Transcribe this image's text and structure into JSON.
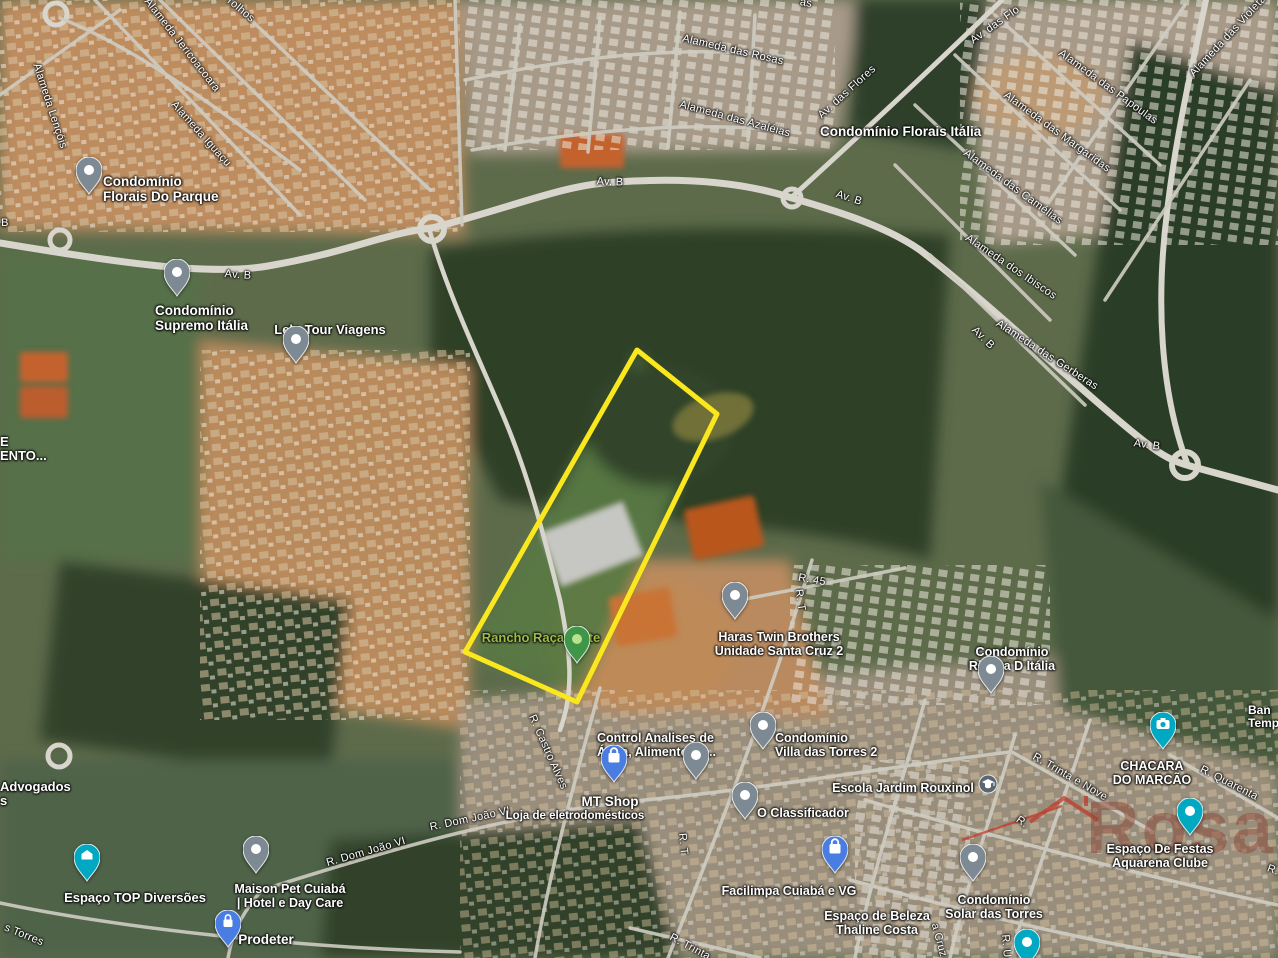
{
  "map": {
    "type": "satellite-map",
    "watermark": {
      "text": "Rosa",
      "text_color": "#8a4434",
      "accent_color": "#c0392b"
    },
    "property_outline": {
      "color": "#fbe71d",
      "points": "637,350 717,414 577,702 465,652"
    },
    "pin_colors": {
      "gray": "#7e8a93",
      "blue": "#4a7de2",
      "teal": "#00a9c1",
      "green": "#3f9648"
    },
    "street_labels": [
      {
        "t": "Alameda Jericoacoara",
        "x": 182,
        "y": 45,
        "r": 52
      },
      {
        "t": "rolhos",
        "x": 241,
        "y": 10,
        "r": 40
      },
      {
        "t": "Alameda Lençóis",
        "x": 50,
        "y": 106,
        "r": 72
      },
      {
        "t": "Alameda Iguaçu",
        "x": 201,
        "y": 134,
        "r": 48
      },
      {
        "t": "B",
        "x": 5,
        "y": 223,
        "r": 0
      },
      {
        "t": "Av. B",
        "x": 238,
        "y": 275,
        "r": 4
      },
      {
        "t": "Av. B",
        "x": 610,
        "y": 182,
        "r": 2
      },
      {
        "t": "Av. B",
        "x": 849,
        "y": 198,
        "r": 18
      },
      {
        "t": "Av. das Flores",
        "x": 847,
        "y": 92,
        "r": -42
      },
      {
        "t": "Av. das Flo",
        "x": 995,
        "y": 25,
        "r": -35
      },
      {
        "t": "as",
        "x": 806,
        "y": 3,
        "r": 10
      },
      {
        "t": "Alameda das Rosas",
        "x": 733,
        "y": 50,
        "r": 13
      },
      {
        "t": "Alameda das Azaléias",
        "x": 735,
        "y": 119,
        "r": 15
      },
      {
        "t": "Alameda das Papoulas",
        "x": 1108,
        "y": 87,
        "r": 36
      },
      {
        "t": "Alameda das Violeta",
        "x": 1228,
        "y": 36,
        "r": -47
      },
      {
        "t": "Alameda das Margaridas",
        "x": 1057,
        "y": 132,
        "r": 36
      },
      {
        "t": "Alameda das Camélias",
        "x": 1013,
        "y": 187,
        "r": 36
      },
      {
        "t": "Alameda dos Ibiscos",
        "x": 1011,
        "y": 267,
        "r": 34
      },
      {
        "t": "Alameda das Gerberas",
        "x": 1047,
        "y": 355,
        "r": 33
      },
      {
        "t": "Av. B",
        "x": 983,
        "y": 338,
        "r": 45
      },
      {
        "t": "Av. B",
        "x": 1147,
        "y": 445,
        "r": 8
      },
      {
        "t": "R. 45",
        "x": 812,
        "y": 580,
        "r": 10
      },
      {
        "t": "R. T",
        "x": 800,
        "y": 600,
        "r": 82
      },
      {
        "t": "R. T",
        "x": 683,
        "y": 844,
        "r": 85
      },
      {
        "t": "R. Castro Alves",
        "x": 548,
        "y": 752,
        "r": 66
      },
      {
        "t": "R. Dom João VI",
        "x": 470,
        "y": 819,
        "r": -12
      },
      {
        "t": "R. Dom João VI",
        "x": 366,
        "y": 852,
        "r": -16
      },
      {
        "t": "R. Trinta e Nove",
        "x": 1070,
        "y": 777,
        "r": 30
      },
      {
        "t": "R. Quarenta",
        "x": 1229,
        "y": 783,
        "r": 27
      },
      {
        "t": "R.",
        "x": 1022,
        "y": 822,
        "r": 35
      },
      {
        "t": "R. Trinta",
        "x": 690,
        "y": 947,
        "r": 28
      },
      {
        "t": "R. U",
        "x": 1006,
        "y": 946,
        "r": 85
      },
      {
        "t": "a Cruz",
        "x": 939,
        "y": 940,
        "r": 75
      },
      {
        "t": "s Torres",
        "x": 24,
        "y": 935,
        "r": 22
      },
      {
        "t": "R.",
        "x": 1273,
        "y": 870,
        "r": 20
      }
    ],
    "poi_labels": [
      {
        "lines": [
          "Condomínio",
          "Florais Do Parque"
        ],
        "x": 103,
        "y": 183,
        "align": "left",
        "size": 13.5
      },
      {
        "lines": [
          "Condomínio",
          "Supremo Itália"
        ],
        "x": 155,
        "y": 312,
        "align": "left",
        "size": 13.5
      },
      {
        "lines": [
          "Lelo Tour Viagens"
        ],
        "x": 330,
        "y": 332,
        "align": "center",
        "size": 13
      },
      {
        "lines": [
          "Condomínio Florais Itália"
        ],
        "x": 820,
        "y": 133,
        "align": "left",
        "size": 13.5
      },
      {
        "lines": [
          "Rancho Raça Forte"
        ],
        "x": 541,
        "y": 640,
        "align": "center",
        "size": 13,
        "color": "#9dbb46"
      },
      {
        "lines": [
          "Haras Twin Brothers",
          "Unidade Santa Cruz 2"
        ],
        "x": 779,
        "y": 639,
        "align": "center",
        "size": 12.5
      },
      {
        "lines": [
          "Condomínio",
          "Riviera D Itália"
        ],
        "x": 1012,
        "y": 654,
        "align": "center",
        "size": 12.5
      },
      {
        "lines": [
          "Control Analises de",
          "Água, Alimentos e..."
        ],
        "x": 597,
        "y": 740,
        "align": "left",
        "size": 12.5
      },
      {
        "lines": [
          "Condomínio",
          "Villa das Torres 2"
        ],
        "x": 775,
        "y": 740,
        "align": "left",
        "size": 12.5
      },
      {
        "lines": [
          "MT Shop"
        ],
        "x": 610,
        "y": 803,
        "align": "center",
        "size": 13.5
      },
      {
        "lines": [
          "Loja de eletrodomésticos"
        ],
        "x": 575,
        "y": 818,
        "align": "center",
        "size": 11.5
      },
      {
        "lines": [
          "O Classificador"
        ],
        "x": 803,
        "y": 815,
        "align": "center",
        "size": 12.5
      },
      {
        "lines": [
          "Escola Jardim Rouxinol"
        ],
        "x": 903,
        "y": 790,
        "align": "center",
        "size": 12.5
      },
      {
        "lines": [
          "CHACARA",
          "DO MARCÃO"
        ],
        "x": 1152,
        "y": 768,
        "align": "center",
        "size": 12.5
      },
      {
        "lines": [
          "Espaço De Festas",
          "Aquarena Clube"
        ],
        "x": 1160,
        "y": 851,
        "align": "center",
        "size": 12.5
      },
      {
        "lines": [
          "Condomínio",
          "Solar das Torres"
        ],
        "x": 994,
        "y": 902,
        "align": "center",
        "size": 12.5
      },
      {
        "lines": [
          "Espaço de Beleza",
          "Thaline Costa"
        ],
        "x": 877,
        "y": 918,
        "align": "center",
        "size": 12.5
      },
      {
        "lines": [
          "Espaço TOP Diversões"
        ],
        "x": 135,
        "y": 900,
        "align": "center",
        "size": 13
      },
      {
        "lines": [
          "Maison Pet Cuiabá",
          "| Hotel e Day Care"
        ],
        "x": 290,
        "y": 891,
        "align": "center",
        "size": 12.5
      },
      {
        "lines": [
          "Prodeter"
        ],
        "x": 266,
        "y": 941,
        "align": "center",
        "size": 13.5
      },
      {
        "lines": [
          "Facilimpa Cuiabá e VG"
        ],
        "x": 789,
        "y": 893,
        "align": "center",
        "size": 12.5
      },
      {
        "lines": [
          "Advogados",
          "s"
        ],
        "x": 0,
        "y": 789,
        "align": "left",
        "size": 13
      },
      {
        "lines": [
          "E",
          "ENTO..."
        ],
        "x": 0,
        "y": 444,
        "align": "left",
        "size": 13
      },
      {
        "lines": [
          "Ban",
          "Temp"
        ],
        "x": 1248,
        "y": 712,
        "align": "left",
        "size": 12
      }
    ],
    "pins": [
      {
        "x": 89,
        "y": 183,
        "color": "gray",
        "icon": "dot",
        "name": "condominio-florais-do-parque"
      },
      {
        "x": 177,
        "y": 285,
        "color": "gray",
        "icon": "dot",
        "name": "condominio-supremo-italia"
      },
      {
        "x": 296,
        "y": 352,
        "color": "gray",
        "icon": "dot",
        "name": "lelo-tour-viagens"
      },
      {
        "x": 577,
        "y": 652,
        "color": "green",
        "icon": "dot",
        "name": "rancho-raca-forte"
      },
      {
        "x": 735,
        "y": 608,
        "color": "gray",
        "icon": "dot",
        "name": "haras-twin-brothers"
      },
      {
        "x": 991,
        "y": 682,
        "color": "gray",
        "icon": "dot",
        "name": "condominio-riviera-d-italia"
      },
      {
        "x": 696,
        "y": 768,
        "color": "gray",
        "icon": "dot",
        "name": "control-analises"
      },
      {
        "x": 614,
        "y": 771,
        "color": "blue",
        "icon": "bag",
        "name": "mt-shop"
      },
      {
        "x": 763,
        "y": 738,
        "color": "gray",
        "icon": "dot",
        "name": "condominio-villa-das-torres-2"
      },
      {
        "x": 745,
        "y": 808,
        "color": "gray",
        "icon": "dot",
        "name": "o-classificador"
      },
      {
        "x": 1163,
        "y": 738,
        "color": "teal",
        "icon": "camera",
        "name": "chacara-do-marcao"
      },
      {
        "x": 1190,
        "y": 824,
        "color": "teal",
        "icon": "dot",
        "name": "espaco-de-festas-aquarena"
      },
      {
        "x": 973,
        "y": 870,
        "color": "gray",
        "icon": "dot",
        "name": "condominio-solar-das-torres"
      },
      {
        "x": 87,
        "y": 870,
        "color": "teal",
        "icon": "house",
        "name": "espaco-top-diversoes"
      },
      {
        "x": 256,
        "y": 862,
        "color": "gray",
        "icon": "dot",
        "name": "maison-pet-cuiaba"
      },
      {
        "x": 228,
        "y": 936,
        "color": "blue",
        "icon": "lock",
        "name": "prodeter"
      },
      {
        "x": 835,
        "y": 862,
        "color": "blue",
        "icon": "bag",
        "name": "facilimpa-cuiaba"
      },
      {
        "x": 1027,
        "y": 955,
        "color": "teal",
        "icon": "dot",
        "name": "clipped-bottom-pin"
      }
    ],
    "badges": [
      {
        "x": 988,
        "y": 784,
        "icon": "graduation-cap",
        "name": "escola-jardim-rouxinol"
      }
    ]
  }
}
